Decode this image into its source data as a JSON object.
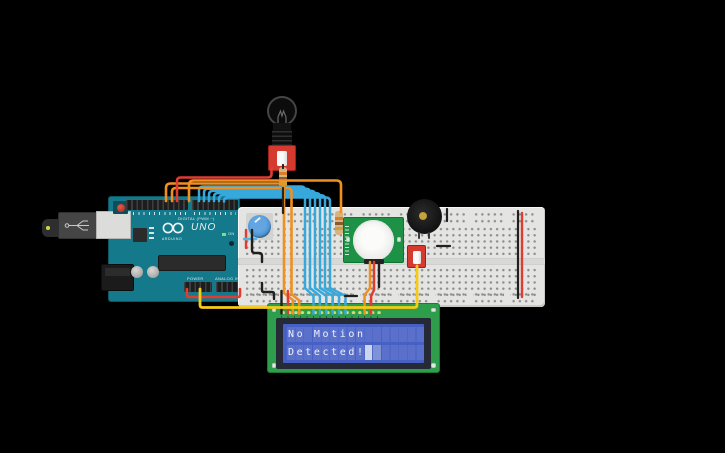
{
  "window": {
    "background": "#000000"
  },
  "arduino": {
    "uno": "UNO",
    "brand": "ARDUINO",
    "digital_label": "DIGITAL (PWM ~)",
    "power_label": "POWER",
    "analog_label": "ANALOG IN",
    "on_label": "ON"
  },
  "lcd": {
    "line1": "No Motion",
    "line2": "Detected!"
  },
  "colors": {
    "arduino_teal": "#14798B",
    "breadboard": "#E4E4E2",
    "lcd_green": "#2E9E4C",
    "lcd_screen_blue": "#4760C4",
    "pir_green": "#1D9145",
    "switch_red": "#D63A2E",
    "wire_orange": "#EF9021",
    "wire_red": "#E03C31",
    "wire_yellow": "#F6CB16",
    "wire_cyan": "#36A8DC",
    "wire_black": "#1F1F1F"
  }
}
